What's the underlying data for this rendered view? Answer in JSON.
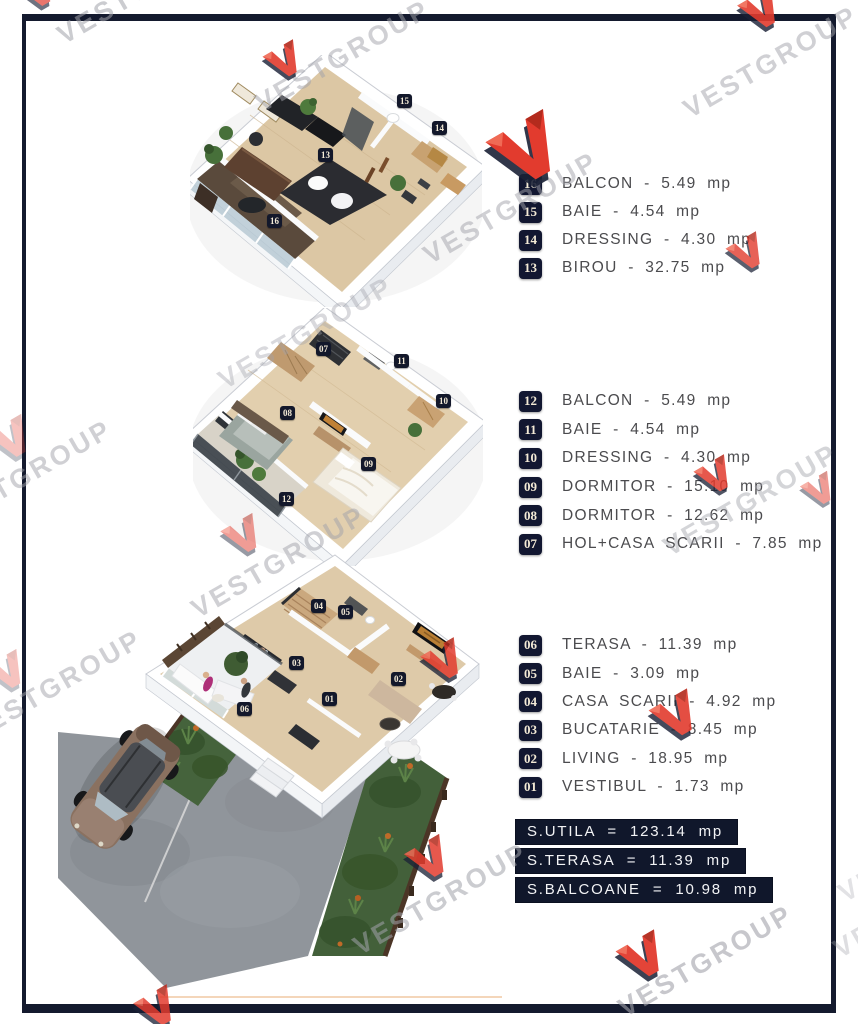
{
  "brand": {
    "watermark_text": "VESTGROUP",
    "logo_red": "#e23b2e",
    "logo_red_dark": "#b32b1d",
    "logo_navy": "#1b2136"
  },
  "frame_color": "#141a2e",
  "units": "mp",
  "floors": [
    {
      "id": "upper-floor",
      "legend": [
        {
          "num": "16",
          "name": "BALCON",
          "area": "5.49 mp",
          "label": "BALCON - 5.49 mp"
        },
        {
          "num": "15",
          "name": "BAIE",
          "area": "4.54 mp",
          "label": "BAIE - 4.54 mp"
        },
        {
          "num": "14",
          "name": "DRESSING",
          "area": "4.30 mp",
          "label": "DRESSING - 4.30 mp"
        },
        {
          "num": "13",
          "name": "BIROU",
          "area": "32.75 mp",
          "label": "BIROU - 32.75 mp"
        }
      ],
      "markers": [
        "13",
        "14",
        "15",
        "16"
      ]
    },
    {
      "id": "middle-floor",
      "legend": [
        {
          "num": "12",
          "name": "BALCON",
          "area": "5.49 mp",
          "label": "BALCON - 5.49 mp"
        },
        {
          "num": "11",
          "name": "BAIE",
          "area": "4.54 mp",
          "label": "BAIE - 4.54 mp"
        },
        {
          "num": "10",
          "name": "DRESSING",
          "area": "4.30 mp",
          "label": "DRESSING - 4.30 mp"
        },
        {
          "num": "09",
          "name": "DORMITOR",
          "area": "15.10 mp",
          "label": "DORMITOR - 15.10 mp"
        },
        {
          "num": "08",
          "name": "DORMITOR",
          "area": "12.62 mp",
          "label": "DORMITOR - 12.62 mp"
        },
        {
          "num": "07",
          "name": "HOL+CASA SCARII",
          "area": "7.85 mp",
          "label": "HOL+CASA SCARII - 7.85 mp"
        }
      ],
      "markers": [
        "07",
        "08",
        "09",
        "10",
        "11",
        "12"
      ]
    },
    {
      "id": "ground-floor",
      "legend": [
        {
          "num": "06",
          "name": "TERASA",
          "area": "11.39 mp",
          "label": "TERASA - 11.39 mp"
        },
        {
          "num": "05",
          "name": "BAIE",
          "area": "3.09 mp",
          "label": "BAIE - 3.09 mp"
        },
        {
          "num": "04",
          "name": "CASA SCARII",
          "area": "4.92 mp",
          "label": "CASA SCARII - 4.92 mp"
        },
        {
          "num": "03",
          "name": "BUCATARIE",
          "area": "8.45 mp",
          "label": "BUCATARIE - 8.45 mp"
        },
        {
          "num": "02",
          "name": "LIVING",
          "area": "18.95 mp",
          "label": "LIVING - 18.95 mp"
        },
        {
          "num": "01",
          "name": "VESTIBUL",
          "area": "1.73 mp",
          "label": "VESTIBUL - 1.73 mp"
        }
      ],
      "markers": [
        "01",
        "02",
        "03",
        "04",
        "05",
        "06"
      ]
    }
  ],
  "summary": [
    {
      "name": "S.UTILA",
      "value": "123.14 mp",
      "label": "S.UTILA = 123.14 mp"
    },
    {
      "name": "S.TERASA",
      "value": "11.39 mp",
      "label": "S.TERASA = 11.39 mp"
    },
    {
      "name": "S.BALCOANE",
      "value": "10.98 mp",
      "label": "S.BALCOANE = 10.98 mp"
    }
  ]
}
